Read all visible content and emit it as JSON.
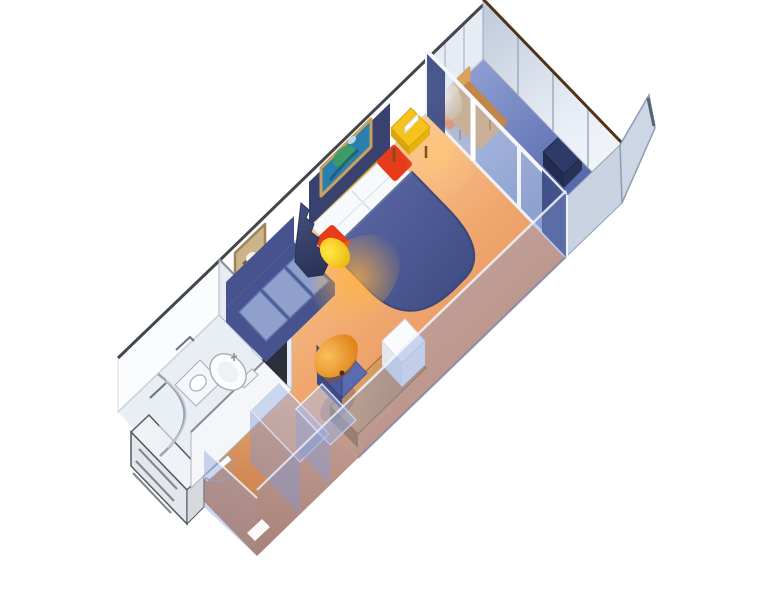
{
  "scene": {
    "title": "3D cutaway rendering of a cruise ship balcony stateroom floor plan",
    "background": "#ffffff"
  },
  "objects": {
    "room": "balcony stateroom",
    "bathroom": "bathroom with shower, toilet and sink",
    "entry": "entry door with hatched threshold",
    "closet": "closet and vanity (translucent cutaway)",
    "sofa": "navy sofa with light blue cushions",
    "divider": "sail-shaped zigzag divider with lamp",
    "bed": "double bed with navy cover, white pillows and red cushions",
    "nightstand": "yellow nightstand table",
    "art_bed": "framed artwork above bed",
    "art_sofa": "framed artwork above sofa",
    "desk": "vanity desk with TV and blue chair",
    "ottoman": "round orange ottoman",
    "glass_doors": "sliding glass balcony doors with curtains",
    "balcony": "private balcony with chairs and table",
    "partition": "balcony partition panels"
  },
  "palette": {
    "carpet_light": "#fbd8ab",
    "carpet_mid": "#f2ab72",
    "carpet_dark": "#e08f58",
    "bath_floor": "#e9edf4",
    "balcony_floor_light": "#8b9cd2",
    "balcony_floor_dark": "#45589e",
    "wall_white": "#ffffff",
    "wall_bath_outer": "#fbfcfd",
    "wall_balcony": "#e6ecf4",
    "wall_top_edge": "#43474d",
    "far_wall_light": "#c3cedd",
    "far_wall_lighter": "#f4f7fb",
    "far_wall_top": "#4e3318",
    "partition": "#ccd6e4",
    "partition_edge": "#8e9cb0",
    "glass": "rgba(208,226,248,0.45)",
    "glass_frame": "#f0f3f8",
    "curtain": "#3c4a82",
    "translucent_wall": "rgba(128,152,214,0.40)",
    "translucent_wall_2": "rgba(135,158,216,0.42)",
    "translucent_wall_edge": "rgba(240,245,255,0.85)",
    "closet_top": "rgba(160,180,228,0.5)",
    "closet_front": "rgba(130,152,210,0.45)",
    "bed_cover_light": "#5a67a4",
    "bed_cover_dark": "#3f4b82",
    "bed_cover_edge": "#3b4779",
    "headboard": "#39426f",
    "headboard_trim": "#c9a227",
    "pillow": "#f7f9fc",
    "pillow_seam": "#d8dee6",
    "red_cushion": "#e63c1c",
    "nightstand_yellow": "#f6c31e",
    "nightstand_yellow_dark": "#d9a509",
    "lamp_yellow": "#ffe84a",
    "lamp_dark": "#eeb90c",
    "sofa_navy": "#46538e",
    "sofa_cushion": "#8fa0cd",
    "sofa_cushion_edge": "#5f74ab",
    "fin_light": "#424e7e",
    "fin_navy": "#2a3354",
    "ottoman_light": "#fbbf5e",
    "ottoman_dark": "#e08418",
    "wood_light": "#e5ad70",
    "wood_dark": "#bb8045",
    "desk_skirt": "#a87038",
    "chair_blue": "#5b6cae",
    "chair_blue_dark": "#3e4c86",
    "chair_back": "#4a5a9c",
    "tv_white": "#fafbfe",
    "tv_side": "#e2e7ee",
    "tv_right": "#eef1f6",
    "lounge_tan": "#c08748",
    "lounge_tan_light": "#d9a35f",
    "balcony_chair_orange": "#e25c1e",
    "balcony_table_navy": "#2e3a68",
    "balcony_table_dark": "#222c52",
    "art_bed_teal": "#2b7fae",
    "art_bed_green": "#3f9f5f",
    "art_frame": "#c8a060",
    "art_sofa_fill": "#cdb58a",
    "art_sofa_frame": "#a08455",
    "fixture_white": "#f4f6f9",
    "fixture_stroke": "#a8b0bb",
    "door_opening": "#2a2f3a",
    "hatch_face": "#e3e6ea",
    "hatch_top": "#f0f2f5",
    "hatch_side": "#d6dade",
    "hatch_line": "#80868e",
    "glow_warm": "#ffb240"
  }
}
